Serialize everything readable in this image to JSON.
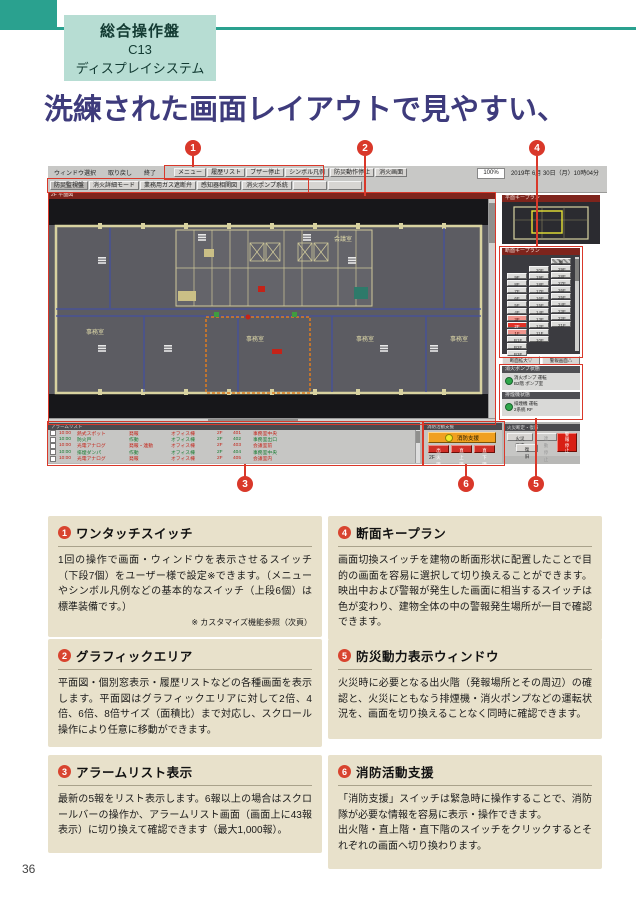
{
  "page": {
    "number": "36"
  },
  "header": {
    "tag_line1": "総合操作盤",
    "tag_line2": "C13",
    "tag_line3": "ディスプレイシステム",
    "title": "洗練された画面レイアウトで見やすい、"
  },
  "callouts": [
    "1",
    "2",
    "3",
    "4",
    "5",
    "6"
  ],
  "ui": {
    "menubar": {
      "left_items": [
        "ウィンドウ選択",
        "取り戻し",
        "終了"
      ],
      "quick_buttons": [
        "メニュー",
        "履歴リスト",
        "ブザー停止",
        "シンボル凡例",
        "防災動作停止",
        "消火画面"
      ],
      "zoom": "100%",
      "datetime": "2019年 6月 30日（月）10時04分"
    },
    "onetouch_buttons": [
      "防災監視盤",
      "消火詳細モード",
      "業務用ガス遮断弁",
      "感知器相関図",
      "消火ポンプ系統",
      "",
      ""
    ],
    "graphic": {
      "title": "2F 平面図",
      "plan": {
        "office": "事務室",
        "meeting": "会議室"
      }
    },
    "overview": {
      "title": "平面キープラン"
    },
    "keyplan": {
      "title": "断面キープラン",
      "columns": {
        "low": [
          {
            "label": "9F"
          },
          {
            "label": "8F"
          },
          {
            "label": "7F"
          },
          {
            "label": "6F"
          },
          {
            "label": "5F"
          },
          {
            "label": "4F"
          },
          {
            "label": "3F",
            "state": "upper"
          },
          {
            "label": "2F",
            "state": "fire"
          },
          {
            "label": "1F",
            "state": "lower"
          },
          {
            "label": "B1F"
          },
          {
            "label": "B2F"
          },
          {
            "label": "B3F"
          }
        ],
        "mid": [
          {
            "label": "20F"
          },
          {
            "label": "19F"
          },
          {
            "label": "18F"
          },
          {
            "label": "17F"
          },
          {
            "label": "16F"
          },
          {
            "label": "15F"
          },
          {
            "label": "14F"
          },
          {
            "label": "13F"
          },
          {
            "label": "12F"
          },
          {
            "label": "11F"
          },
          {
            "label": "10F"
          }
        ],
        "high": [
          {
            "label": "屋上",
            "state": "roof"
          },
          {
            "label": "29F"
          },
          {
            "label": "28F"
          },
          {
            "label": "27F"
          },
          {
            "label": "26F"
          },
          {
            "label": "25F"
          },
          {
            "label": "24F"
          },
          {
            "label": "23F"
          },
          {
            "label": "22F"
          },
          {
            "label": "21F"
          }
        ]
      },
      "buttons": [
        "断面拡大▽",
        "警報画面△"
      ]
    },
    "power_panels": [
      {
        "title": "消火ポンプ状態",
        "line1": "消火ポンプ 運転",
        "line2": "B2階 ポンプ室"
      },
      {
        "title": "排煙機状態",
        "line1": "排煙機 運転",
        "line2": "2系統 RF"
      }
    ],
    "alarm_list": {
      "title": "アラームリスト",
      "rows": [
        {
          "time": "10:00",
          "device": "熱式スポット",
          "status": "発報",
          "area": "オフィス棟",
          "floor": "2F",
          "zone": "401",
          "location": "事務室中央",
          "color": "red"
        },
        {
          "time": "10:00",
          "device": "防火戸",
          "status": "作動",
          "area": "オフィス棟",
          "floor": "2F",
          "zone": "402",
          "location": "事務室出口",
          "color": "green"
        },
        {
          "time": "10:00",
          "device": "光電アナログ",
          "status": "発報・連動",
          "area": "オフィス棟",
          "floor": "2F",
          "zone": "403",
          "location": "会議室前",
          "color": "red"
        },
        {
          "time": "10:00",
          "device": "排煙ダンパ",
          "status": "作動",
          "area": "オフィス棟",
          "floor": "2F",
          "zone": "404",
          "location": "事務室中央",
          "color": "green"
        },
        {
          "time": "10:00",
          "device": "光電アナログ",
          "status": "発報",
          "area": "オフィス棟",
          "floor": "2F",
          "zone": "405",
          "location": "会議室内",
          "color": "red"
        }
      ]
    },
    "fire_support": {
      "title": "消防活動支援",
      "main_button": "消防支援",
      "floor_buttons": [
        "出火階",
        "直上階",
        "直下階"
      ],
      "floor_label": "2F"
    },
    "control": {
      "title": "火災断定・復旧",
      "btn1": "火災断定",
      "btn2": "連動停止",
      "btn3": "復旧",
      "red_button": "警報停止"
    }
  },
  "boxes": [
    {
      "num": "1",
      "title": "ワンタッチスイッチ",
      "body": "1回の操作で画面・ウィンドウを表示させるスイッチ（下段7個）をユーザー様で設定※できます。（メニューやシンボル凡例などの基本的なスイッチ（上段6個）は標準装備です。）",
      "note": "※ カスタマイズ機能参照（次頁）"
    },
    {
      "num": "2",
      "title": "グラフィックエリア",
      "body": "平面図・個別窓表示・履歴リストなどの各種画面を表示します。平面図はグラフィックエリアに対して2倍、4倍、6倍、8倍サイズ（面積比）まで対応し、スクロール操作により任意に移動ができます。"
    },
    {
      "num": "3",
      "title": "アラームリスト表示",
      "body": "最新の5報をリスト表示します。6報以上の場合はスクロールバーの操作か、アラームリスト画面（画面上に43報表示）に切り換えて確認できます（最大1,000報）。"
    },
    {
      "num": "4",
      "title": "断面キープラン",
      "body": "画面切換スイッチを建物の断面形状に配置したことで目的の画面を容易に選択して切り換えることができます。映出中および警報が発生した画面に相当するスイッチは色が変わり、建物全体の中の警報発生場所が一目で確認できます。"
    },
    {
      "num": "5",
      "title": "防災動力表示ウィンドウ",
      "body": "火災時に必要となる出火階（発報場所とその周辺）の確認と、火災にともなう排煙機・消火ポンプなどの運転状況を、画面を切り換えることなく同時に確認できます。"
    },
    {
      "num": "6",
      "title": "消防活動支援",
      "body": "「消防支援」スイッチは緊急時に操作することで、消防隊が必要な情報を容易に表示・操作できます。",
      "body2": "出火階・直上階・直下階のスイッチをクリックするとそれぞれの画面へ切り換わります。"
    }
  ]
}
